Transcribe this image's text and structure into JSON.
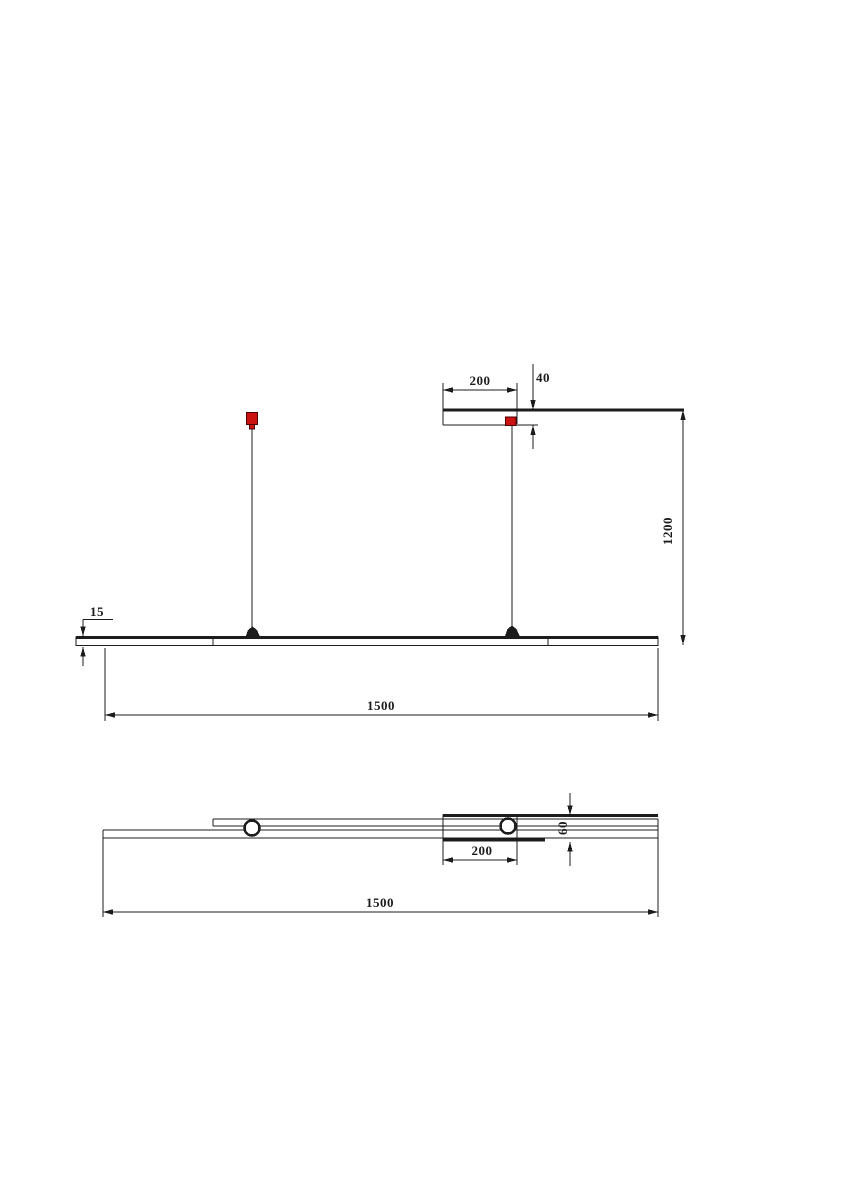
{
  "drawing": {
    "type": "technical-dimension-drawing",
    "subject": "linear-pendant-lamp",
    "background": "#ffffff",
    "line_color": "#1c1c1c",
    "accent_red": "#cc1111",
    "views": {
      "elevation": {
        "dims": {
          "canopy_width": "200",
          "canopy_height": "40",
          "drop_height": "1200",
          "bar_thickness": "15",
          "bar_length": "1500"
        }
      },
      "plan": {
        "dims": {
          "canopy_width": "200",
          "canopy_depth": "60",
          "bar_length": "1500"
        }
      }
    }
  }
}
